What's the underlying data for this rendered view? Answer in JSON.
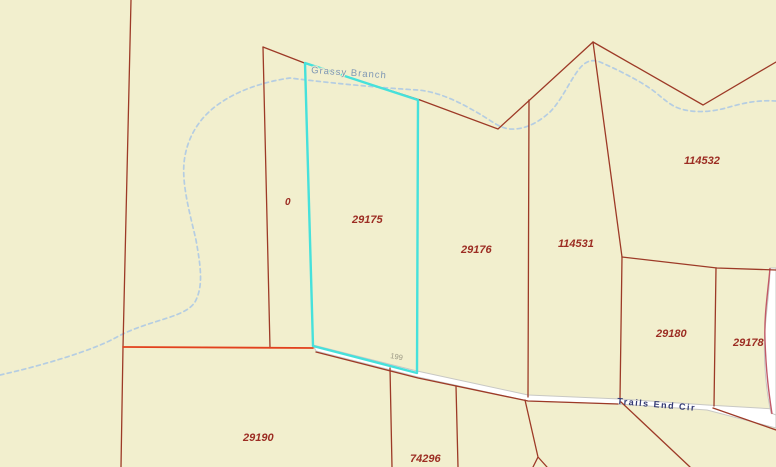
{
  "map": {
    "colors": {
      "bg": "#f2efce",
      "parcel_line": "#9d3a27",
      "highlight_line": "#e2411d",
      "selected_outline": "#46e1db",
      "creek": "#b5cde2",
      "road_fill": "#ffffff",
      "road_edge": "#c8c8c4",
      "curve_road_edge": "#c15a68",
      "parcel_label": "#9c2d23",
      "creek_label": "#7d96b4",
      "road_label": "#333a74",
      "address_label": "#9b9884"
    },
    "labels": {
      "creek": "Grassy Branch",
      "road": "Trails End Cir",
      "address": "199"
    },
    "parcels": [
      {
        "id": "0",
        "selected": false
      },
      {
        "id": "29175",
        "selected": true
      },
      {
        "id": "29176",
        "selected": false
      },
      {
        "id": "114531",
        "selected": false
      },
      {
        "id": "114532",
        "selected": false
      },
      {
        "id": "29180",
        "selected": false
      },
      {
        "id": "29178",
        "selected": false
      },
      {
        "id": "29190",
        "selected": false
      },
      {
        "id": "74296",
        "selected": false
      }
    ]
  }
}
